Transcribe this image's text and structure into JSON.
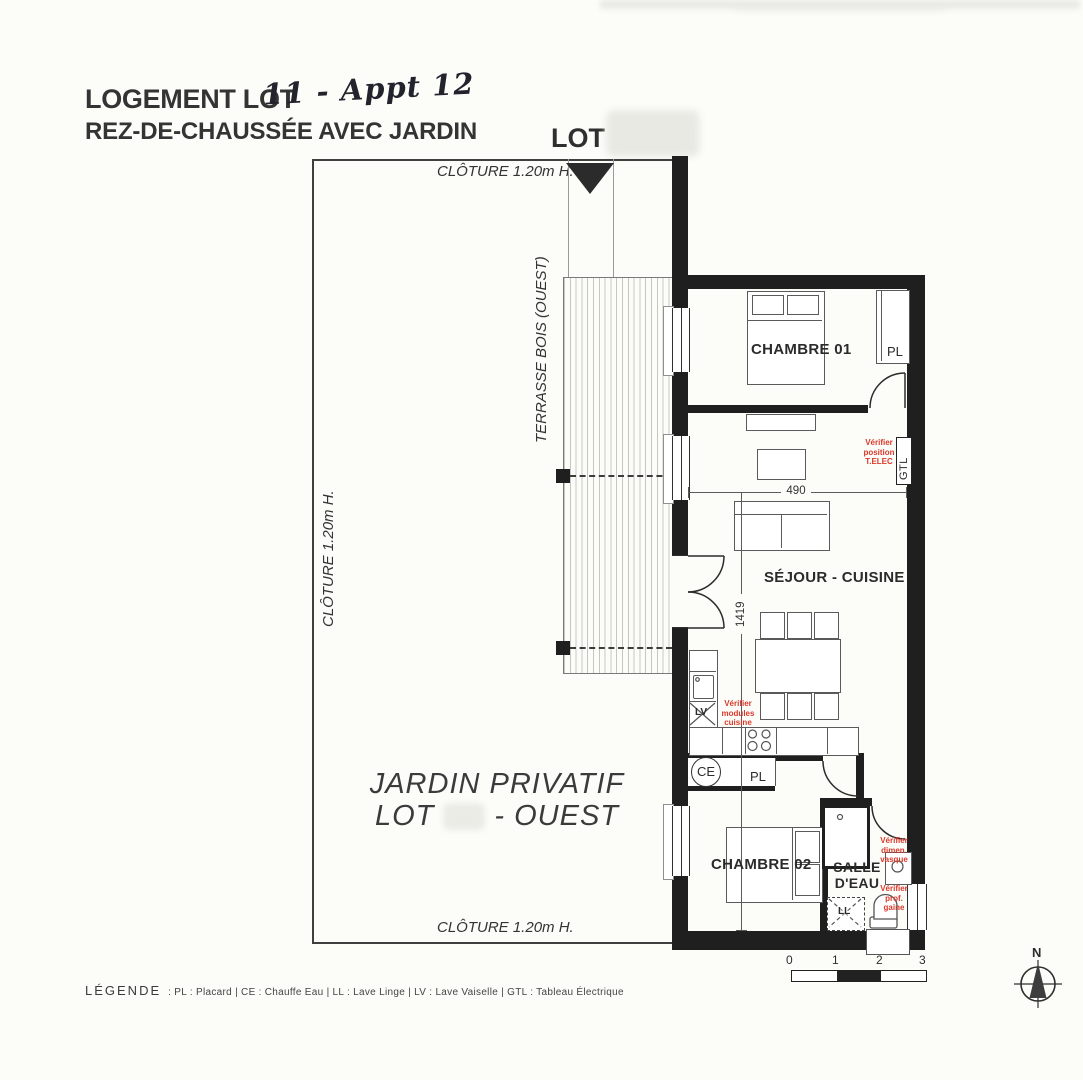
{
  "header": {
    "title_printed": "LOGEMENT LOT",
    "title_handwritten": "11 - Appt 12",
    "subtitle": "REZ-DE-CHAUSSÉE AVEC JARDIN",
    "lot_label": "LOT"
  },
  "fence": {
    "top": "CLÔTURE 1.20m H.",
    "left": "CLÔTURE 1.20m H.",
    "bottom": "CLÔTURE 1.20m H."
  },
  "terrace": {
    "label": "TERRASSE BOIS (OUEST)"
  },
  "garden": {
    "line1": "JARDIN PRIVATIF",
    "line2_prefix": "LOT",
    "line2_suffix": "- OUEST"
  },
  "rooms": {
    "chambre01": "CHAMBRE 01",
    "sejour_cuisine": "SÉJOUR - CUISINE",
    "chambre02": "CHAMBRE 02",
    "salle_eau_l1": "SALLE",
    "salle_eau_l2": "D'EAU"
  },
  "fixtures": {
    "pl_chambre01": "PL",
    "pl_hall": "PL",
    "gtl": "GTL",
    "ce": "CE",
    "lv": "LV",
    "ll": "LL"
  },
  "dimensions": {
    "sejour_width_cm": "490",
    "apartment_length_cm": "1419"
  },
  "annotations": {
    "telec": [
      "Vérifier",
      "position",
      "T.ELEC"
    ],
    "cuisine": [
      "Vérifier",
      "modules",
      "cuisine"
    ],
    "vasque": [
      "Vérifier",
      "dimen.",
      "vasque"
    ],
    "gaine": [
      "Vérifier",
      "prof.",
      "gaine"
    ]
  },
  "legend": {
    "title": "LÉGENDE",
    "entries": ": PL : Placard | CE : Chauffe Eau | LL : Lave Linge | LV : Lave Vaiselle | GTL : Tableau Électrique"
  },
  "scale_bar": {
    "ticks": [
      "0",
      "1",
      "2",
      "3"
    ]
  },
  "compass": {
    "north": "N"
  },
  "colors": {
    "annotation_red": "#d9392a",
    "wall_black": "#1f1f1f"
  }
}
